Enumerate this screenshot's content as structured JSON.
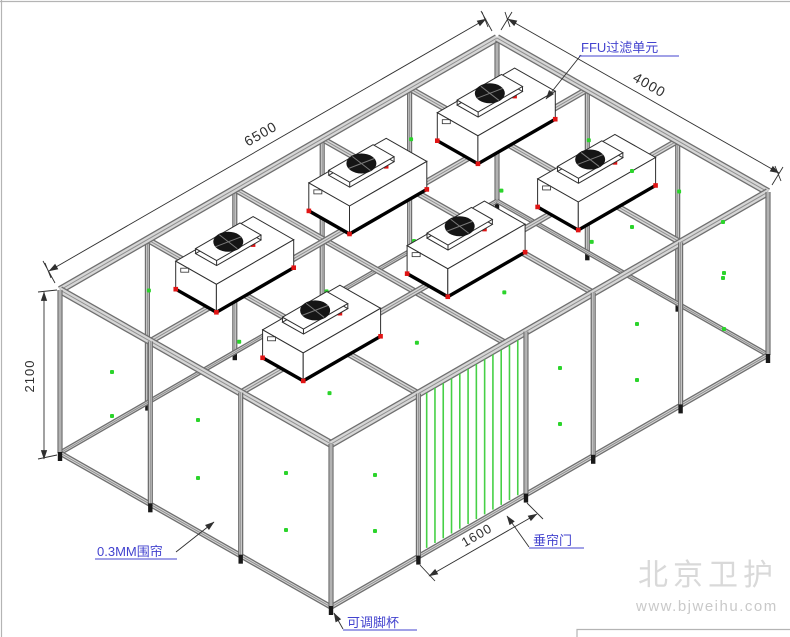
{
  "drawing": {
    "dims": {
      "length": "6500",
      "width": "4000",
      "height": "2100",
      "door_width": "1600"
    },
    "labels": {
      "ffu": "FFU过滤单元",
      "curtain": "0.3MM围帘",
      "door": "垂帘门",
      "foot": "可调脚杯"
    },
    "watermark": {
      "brand": "北京卫护",
      "url": "www.bjweihu.com"
    },
    "colors": {
      "line": "#2e2e2e",
      "beam_edge": "#6f6f6f",
      "beam_fill": "#d6d6d6",
      "beam_center": "#8f8f8f",
      "dim": "#2f2f2f",
      "label_blue": "#4343cf",
      "dot_green": "#2bd42b",
      "curtain_green": "#46d046",
      "ffu_red": "#e11414",
      "fan_black": "#151515",
      "foot_black": "#181818",
      "watermark_text": "#d9d9d9",
      "watermark_url": "#c9c9c9",
      "border_grey": "#b4b4b4"
    }
  }
}
